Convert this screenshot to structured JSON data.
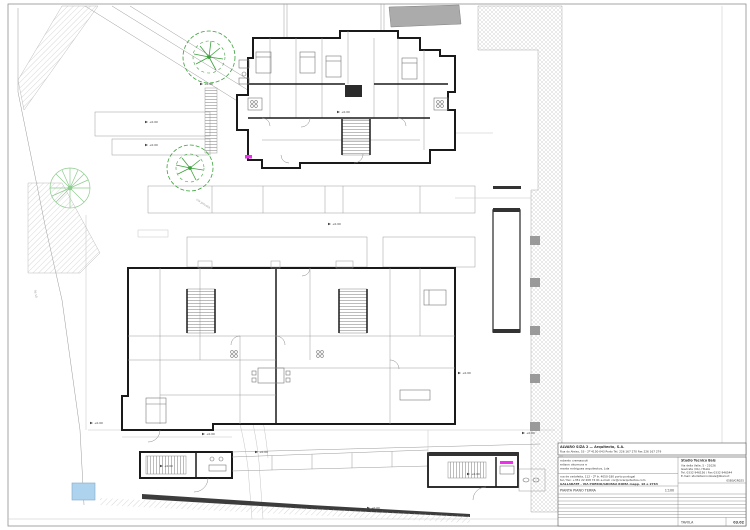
{
  "title_block": {
    "architect_line1": "ALVARO SIZA 2 —   Arquitecto, S.A.",
    "architect_line2": "Rua do Aleixo, 53 - 2º  4150-043  Porto   Tel. 226 167 270  Fax 226 167 279",
    "collab1": "roberto cremascoli",
    "collab2": "edison okumura e",
    "collab3": "marta  rodrigues  arquitectos, Lda",
    "collab_addr1": "rua de cedofeita, 112 - 2º tr.   4050-180   porto   portugal",
    "collab_addr2": "tel / fax: +351 22 208 74 61    e-mail: cor@corarquitectos.com",
    "project_line": "GALLARATE - VIA POERIO/GROSSA ROMA mapp. 16 e 2763",
    "drawing_title": "PIANTA PIANO TERRA",
    "scale": "1:100",
    "studio_name": "Studio Tecnico Bais",
    "studio_addr1": "Via della Valle, 5 - 21026",
    "studio_addr2": "Gavirate (VA), ITALIA",
    "studio_tel": "Tel. 0332 946156 / Fax 0332 946544",
    "studio_email": "E-mail: studiotecnicobais@libero.it",
    "studio_code": "05B0/GR025",
    "tavola_label": "TAVOLA",
    "tavola_number": "03.02"
  },
  "labels": {
    "road": "via privata",
    "boundary_dim": "36.10"
  },
  "markers": [
    {
      "x": 148,
      "y": 122,
      "label": "+0.00"
    },
    {
      "x": 148,
      "y": 145,
      "label": "+0.00"
    },
    {
      "x": 340,
      "y": 112,
      "label": "+0.00"
    },
    {
      "x": 203,
      "y": 84,
      "label": "+0.00"
    },
    {
      "x": 331,
      "y": 224,
      "label": "+0.00"
    },
    {
      "x": 93,
      "y": 423,
      "label": "+0.00"
    },
    {
      "x": 205,
      "y": 434,
      "label": "+0.00"
    },
    {
      "x": 258,
      "y": 452,
      "label": "+0.00"
    },
    {
      "x": 525,
      "y": 433,
      "label": "+0.00"
    },
    {
      "x": 370,
      "y": 508,
      "label": "+0.00"
    },
    {
      "x": 470,
      "y": 474,
      "label": "+0.00"
    },
    {
      "x": 163,
      "y": 466,
      "label": "+0.00"
    },
    {
      "x": 461,
      "y": 373,
      "label": "+0.00"
    }
  ],
  "colors": {
    "tree_dark": "#3aa13a",
    "tree_light": "#8fcc8f",
    "accent_magenta": "#ee30ee",
    "pool_blue": "#aed3ee",
    "wall": "#1a1a1a",
    "neighbor_roof_grey": "#ababab"
  }
}
